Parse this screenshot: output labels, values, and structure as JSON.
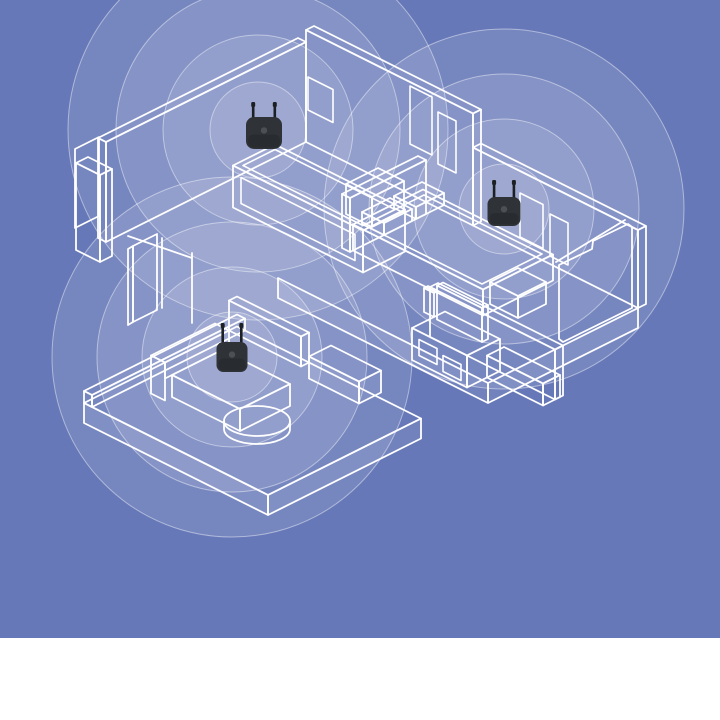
{
  "colors": {
    "background": "#6678b8",
    "line_art": "#ffffff",
    "ring_fill": "rgba(255,255,255,0.11)",
    "ring_stroke": "rgba(255,255,255,0.45)",
    "device_body": "#2f3338",
    "device_antenna": "#1d2023",
    "footer_band": "#ffffff"
  },
  "layout": {
    "canvas_width": 720,
    "canvas_height": 720,
    "illustration_height": 638,
    "footer_height": 82
  },
  "devices": [
    {
      "id": "wifi-extender-1",
      "cx": 264,
      "body_top": 117,
      "body_w": 36,
      "body_h": 32,
      "antenna_len": 15
    },
    {
      "id": "wifi-extender-2",
      "cx": 504,
      "body_top": 197,
      "body_w": 33,
      "body_h": 29,
      "antenna_len": 17
    },
    {
      "id": "wifi-extender-3",
      "cx": 232,
      "body_top": 342,
      "body_w": 31,
      "body_h": 30,
      "antenna_len": 19
    }
  ],
  "coverage": [
    {
      "id": "signal-rings-1",
      "cx": 258,
      "cy": 130,
      "radii": [
        48,
        95,
        142,
        190
      ]
    },
    {
      "id": "signal-rings-2",
      "cx": 504,
      "cy": 209,
      "radii": [
        45,
        90,
        135,
        180
      ]
    },
    {
      "id": "signal-rings-3",
      "cx": 232,
      "cy": 357,
      "radii": [
        45,
        90,
        135,
        180
      ]
    }
  ]
}
